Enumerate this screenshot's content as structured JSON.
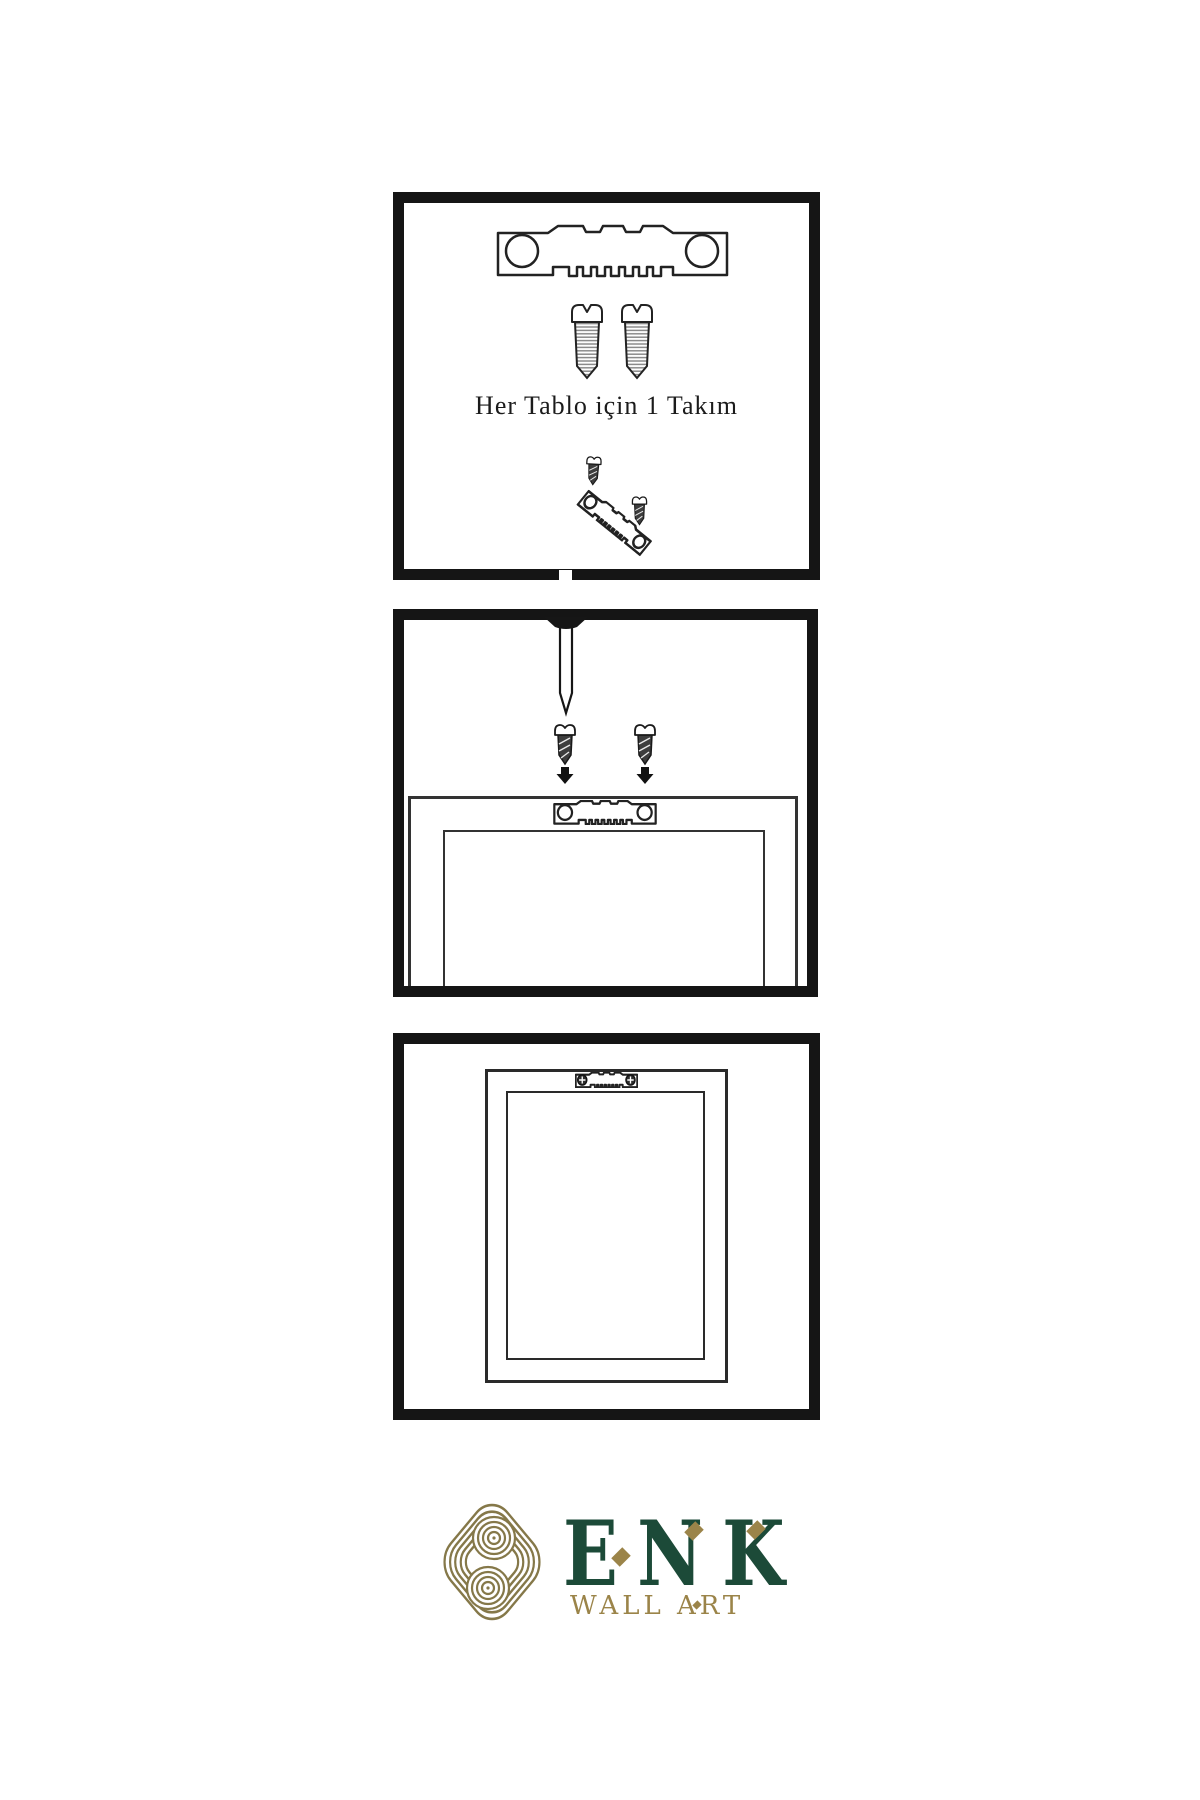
{
  "canvas": {
    "background": "#ffffff",
    "ink": "#1f1f1f"
  },
  "steps": {
    "step1": {
      "caption": "Her Tablo için 1 Takım",
      "icons": [
        "sawtooth-hanger",
        "screw",
        "screw",
        "screw-angled",
        "sawtooth-hanger-angled",
        "screw-small"
      ]
    },
    "step2": {
      "icons": [
        "wall-nail",
        "screw",
        "screw",
        "down-arrow",
        "down-arrow",
        "frame-back",
        "sawtooth-hanger"
      ]
    },
    "step3": {
      "icons": [
        "frame-back-hung",
        "sawtooth-hanger-installed"
      ]
    }
  },
  "brand": {
    "name": "ENK",
    "tagline": "WALL ART",
    "logo_icon": "interlaced-knot",
    "colors": {
      "green": "#1c4a38",
      "gold": "#9b8449",
      "knot_gold": "#857849"
    }
  }
}
